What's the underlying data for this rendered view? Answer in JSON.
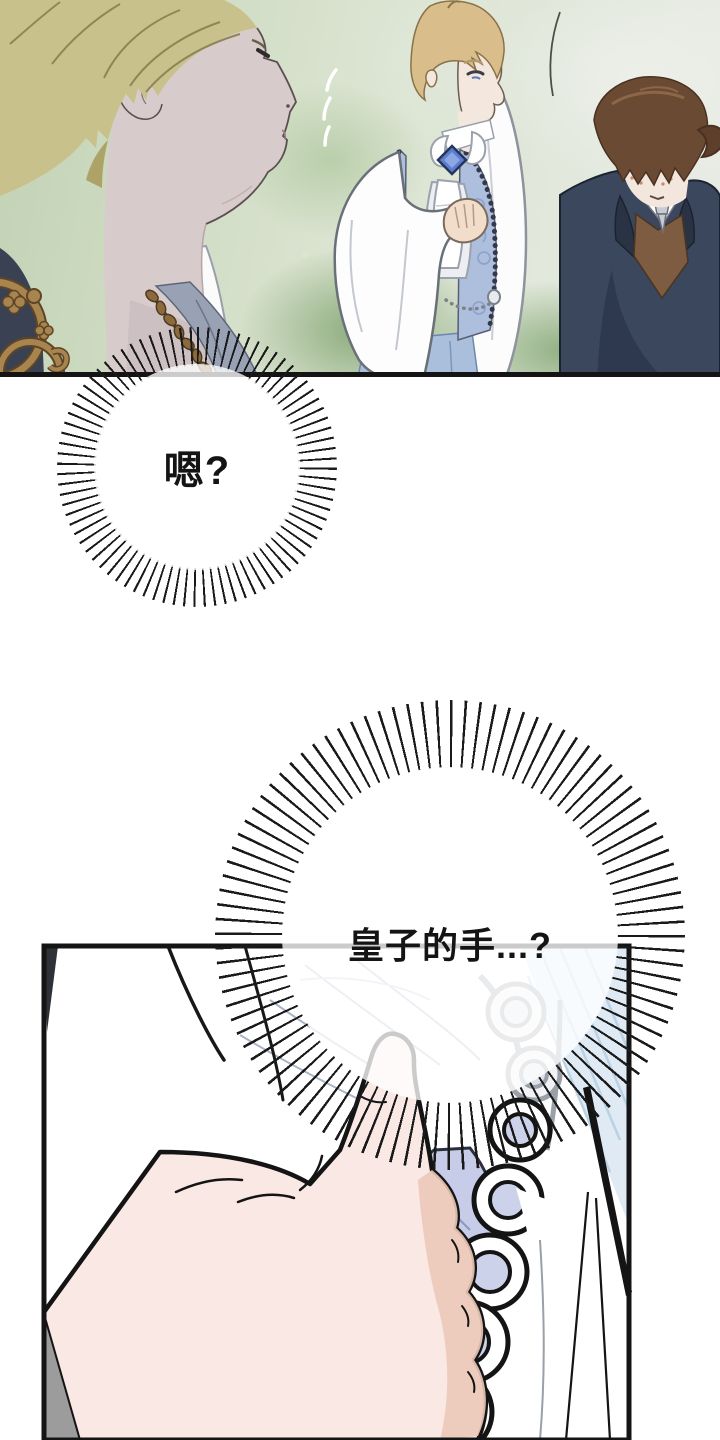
{
  "page": {
    "type": "comic-page",
    "background_color": "#ffffff",
    "ink_color": "#141414"
  },
  "panels": [
    {
      "id": "garden-scene",
      "description": "Blonde noble seen in close profile; a prince in a white shirt, cravat and blue brocade vest raises a hand to his chest; a brown-haired attendant in a navy suit bows",
      "border_color": "#141414",
      "background_green": "#9db88c",
      "prince_vest_blue": "#aebfde",
      "brooch_blue": "#5c7ed0",
      "suit_navy": "#3b475c",
      "vest_brown": "#7d5c42",
      "gold_ornament": "#a8854e"
    },
    {
      "id": "hand-closeup",
      "description": "Close-up of a hand with index finger extended beside an embroidered looped cuff and white drapery",
      "border_color": "#141414",
      "skin_color": "#f9e8e4",
      "cuff_lavender": "#c7cde8",
      "fabric_blue": "#dfeaf4",
      "shadow_grey": "#9c9c9c"
    }
  ],
  "bubbles": [
    {
      "id": "burst-1",
      "shape": "burst",
      "text": "嗯?",
      "fill": "#ffffff",
      "spike_color": "#1a1a1a"
    },
    {
      "id": "burst-2",
      "shape": "burst",
      "text": "皇子的手...?",
      "fill": "#ffffff",
      "spike_color": "#1a1a1a"
    }
  ]
}
